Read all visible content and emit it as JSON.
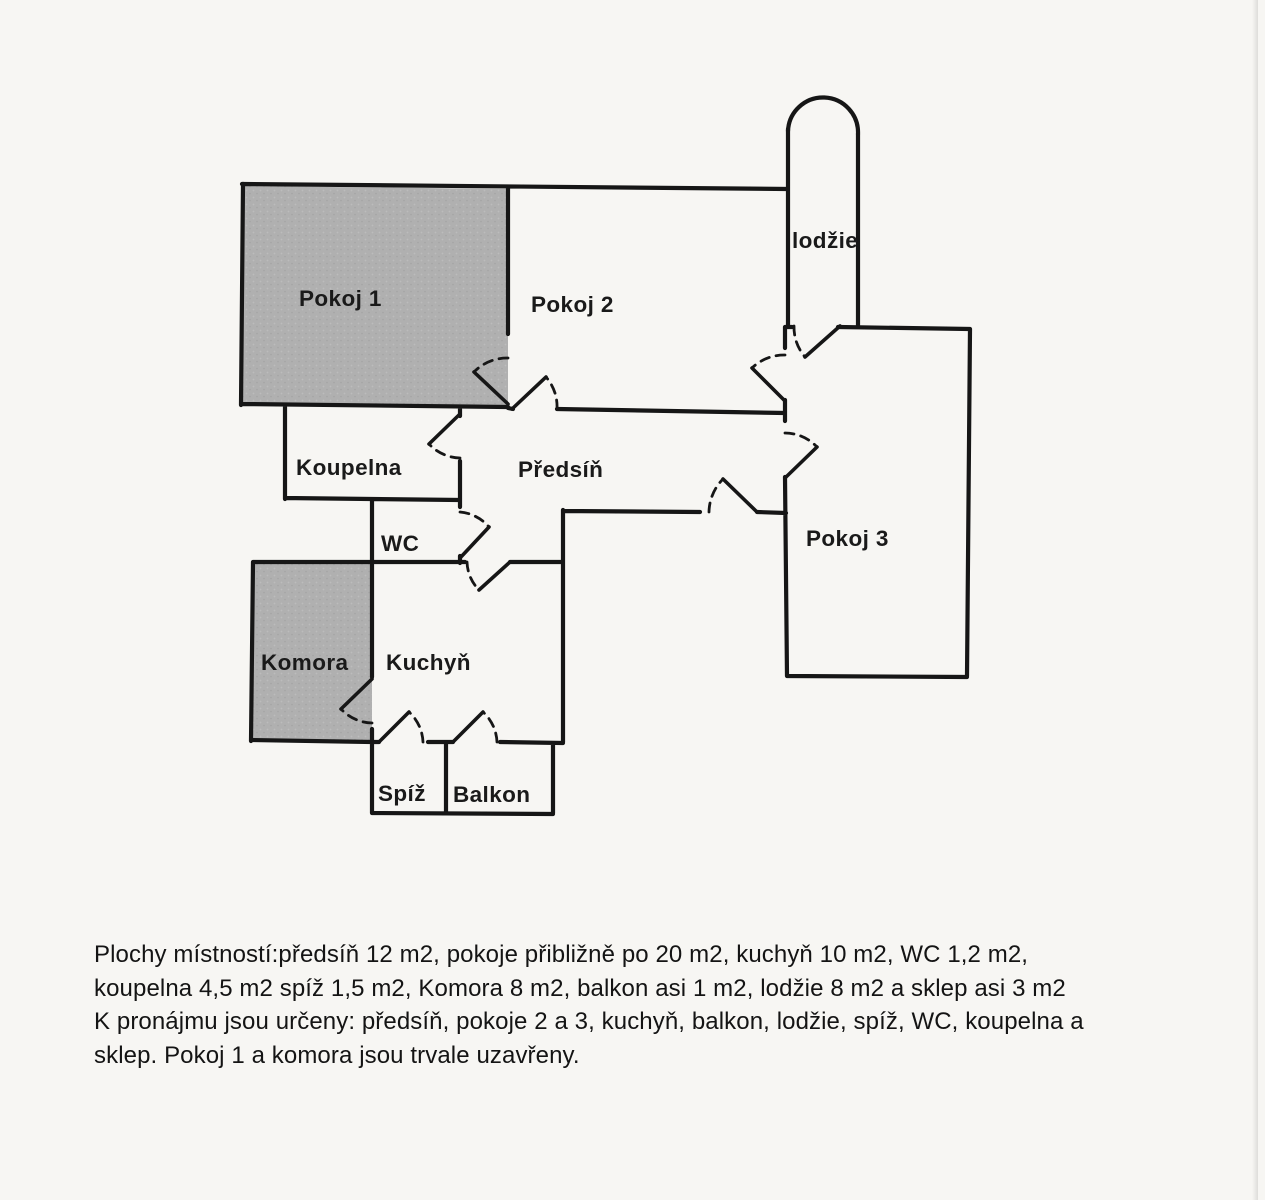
{
  "rooms": {
    "pokoj1": {
      "label": "Pokoj 1",
      "shaded": true
    },
    "pokoj2": {
      "label": "Pokoj 2",
      "shaded": false
    },
    "lodzie": {
      "label": "lodžie",
      "shaded": false
    },
    "pokoj3": {
      "label": "Pokoj 3",
      "shaded": false
    },
    "koupelna": {
      "label": "Koupelna",
      "shaded": false
    },
    "predsin": {
      "label": "Předsíň",
      "shaded": false
    },
    "wc": {
      "label": "WC",
      "shaded": false
    },
    "komora": {
      "label": "Komora",
      "shaded": true
    },
    "kuchyn": {
      "label": "Kuchyň",
      "shaded": false
    },
    "spiz": {
      "label": "Spíž",
      "shaded": false
    },
    "balkon": {
      "label": "Balkon",
      "shaded": false
    }
  },
  "notes": {
    "lines": [
      "Plochy místností:předsíň 12 m2, pokoje přibližně po 20 m2, kuchyň 10 m2, WC 1,2 m2,",
      "koupelna 4,5 m2 spíž 1,5 m2, Komora 8 m2, balkon asi 1 m2, lodžie 8 m2 a sklep asi 3 m2",
      "K pronájmu jsou určeny: předsíň, pokoje 2 a 3, kuchyň, balkon, lodžie, spíž, WC, koupelna a",
      "sklep. Pokoj 1 a komora jsou trvale uzavřeny."
    ]
  },
  "colors": {
    "paper": "#f7f6f3",
    "ink": "#161616",
    "shaded_room": "#b0b0b0"
  }
}
